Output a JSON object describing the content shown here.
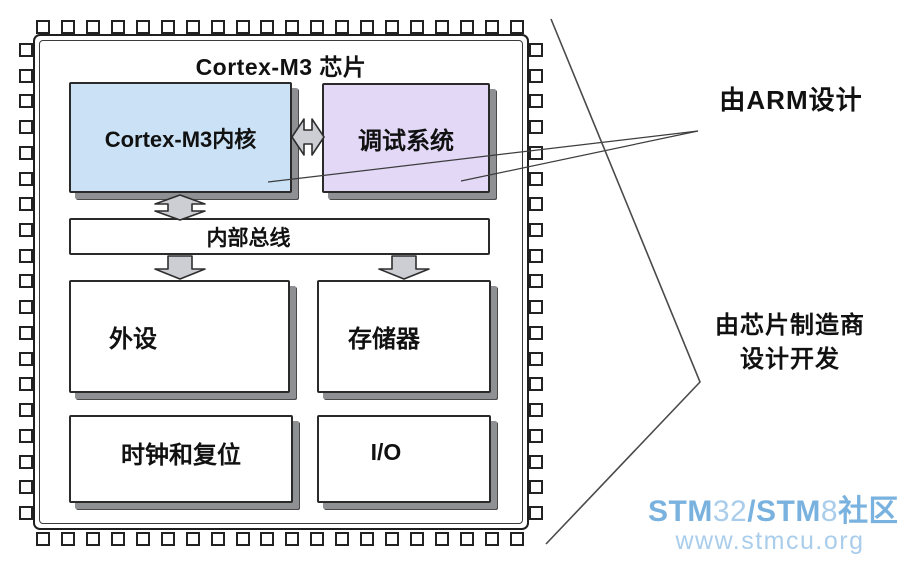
{
  "title": "Cortex-M3 芯片",
  "chip": {
    "blocks": {
      "core": {
        "label": "Cortex-M3内核",
        "fill": "#cbe2f6"
      },
      "debug": {
        "label": "调试系统",
        "fill": "#e3d9f7"
      },
      "bus": {
        "label": "内部总线"
      },
      "peripherals": {
        "label": "外设"
      },
      "memory": {
        "label": "存储器"
      },
      "clock_reset": {
        "label": "时钟和复位"
      },
      "io": {
        "label": "I/O"
      }
    }
  },
  "annotations": {
    "arm_design": "由ARM设计",
    "vendor_design_line1": "由芯片制造商",
    "vendor_design_line2": "设计开发"
  },
  "watermark": {
    "line1_parts": [
      {
        "text": "STM",
        "weight": "bold"
      },
      {
        "text": "32",
        "weight": "light"
      },
      {
        "text": "/STM",
        "weight": "bold"
      },
      {
        "text": "8",
        "weight": "light"
      },
      {
        "text": "社区",
        "weight": "bold"
      }
    ],
    "line2": "www.stmcu.org"
  },
  "colors": {
    "core_fill": "#cbe2f6",
    "debug_fill": "#e3d9f7",
    "arrow_fill": "#cdced4",
    "box_border": "#2a2a2a",
    "bevel_shadow": "#8e9094",
    "watermark_bold_blue": "#79b2df",
    "watermark_light_blue": "#a9cdeb"
  }
}
